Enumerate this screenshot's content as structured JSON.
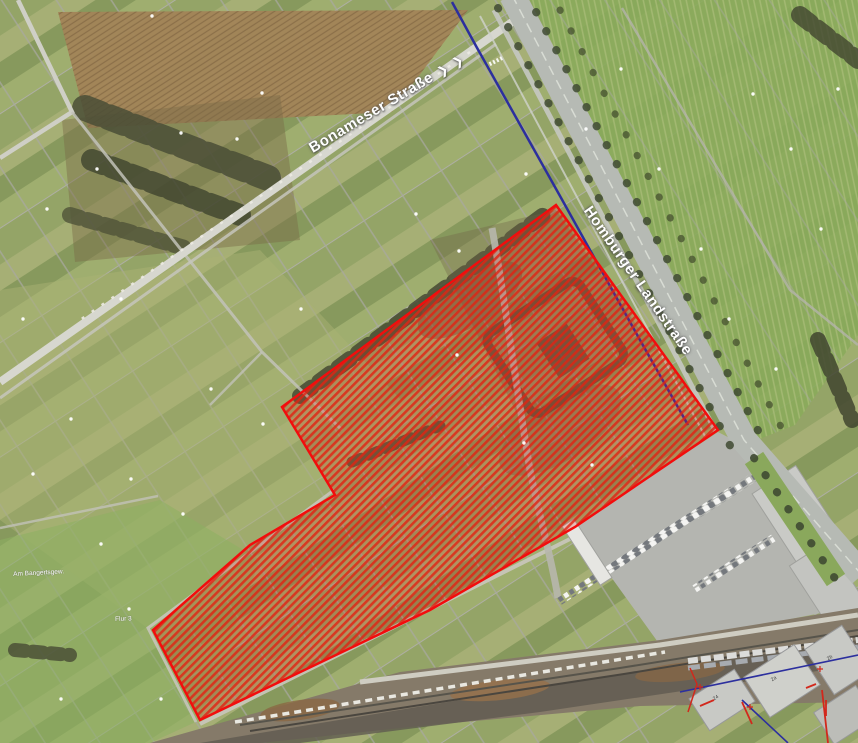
{
  "map": {
    "street_labels": [
      {
        "name": "Bonameser Straße",
        "arrows": "❯ ❯"
      },
      {
        "name": "Homburger Landstraße"
      }
    ],
    "small_labels": [
      {
        "text": "Am Bangertsgew."
      },
      {
        "text": "Flur 3"
      }
    ],
    "building_numbers": [
      "24",
      "2a",
      "2b"
    ],
    "colors": {
      "overlay_fill": "#e02314",
      "overlay_border": "#f20d0d",
      "route_line": "#2c2f9e"
    }
  }
}
